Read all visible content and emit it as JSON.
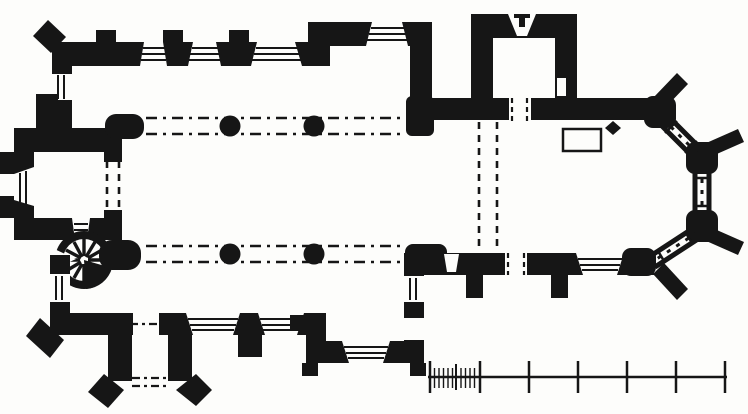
{
  "figure": {
    "type": "architectural-floor-plan",
    "subject": "Medieval church ground plan, engraved style, black ink on white",
    "ink": "#161616",
    "paper": "#fdfdfb",
    "features": [
      {
        "id": "west-tower",
        "label": "West tower with west doorway, flanking buttresses and tower arch shown dashed"
      },
      {
        "id": "spiral-staircase",
        "label": "Round stair turret with radiating winder steps at the tower south-east corner"
      },
      {
        "id": "north-aisle",
        "label": "North aisle: three splayed windows, three wall buttresses, west window, diagonal corner buttress"
      },
      {
        "id": "north-chapel",
        "label": "North chapel projecting beyond the aisle wall with one splayed window"
      },
      {
        "id": "nave-arcades",
        "label": "Nave arcades drawn dashed with two circular piers per side and responds at each end"
      },
      {
        "id": "south-aisle",
        "label": "South aisle: two splayed windows, south doorway, west window, diagonal corner buttress"
      },
      {
        "id": "south-porch",
        "label": "South porch with side walls, outer doorway shown dashed and diagonal buttresses"
      },
      {
        "id": "south-chapel",
        "label": "South chapel projecting beyond the aisle wall with south and east windows"
      },
      {
        "id": "vestry",
        "label": "North vestry with narrow north light, east wall niche and doorway to the chancel"
      },
      {
        "id": "chancel",
        "label": "Chancel with chancel arch dashed, priest's doorway, south doorway, south window and buttresses"
      },
      {
        "id": "apse",
        "label": "Three-sided apse with long traceried windows and diagonal corner buttresses"
      },
      {
        "id": "altar",
        "label": "Altar plinth outline with small lozenge position mark"
      },
      {
        "id": "scale-bar",
        "label": "Plain scale bar of six divisions, the first subdivided into ten"
      }
    ],
    "counts": {
      "arcade_piers": 4,
      "apse_window_faces": 3,
      "scale_bar_major_divisions": 6,
      "scale_bar_minor_ticks_first_division": 10
    }
  }
}
